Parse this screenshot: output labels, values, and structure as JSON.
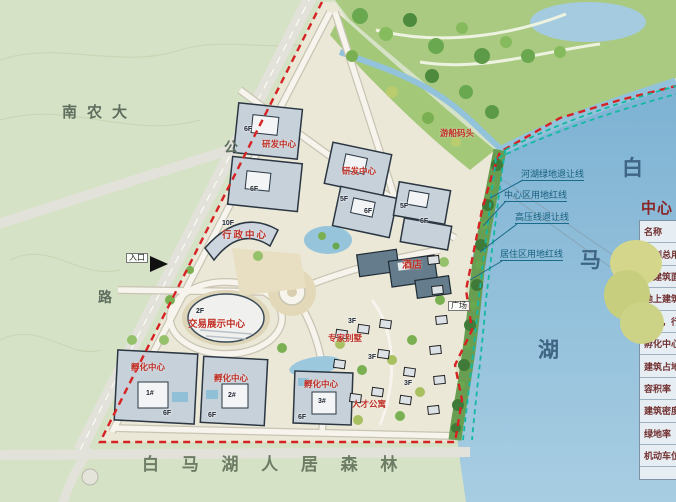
{
  "colors": {
    "boundary_red": "#d62222",
    "setback_teal": "#14b8a3",
    "lake_blue": "#8fbfdc",
    "label_red": "#c03026"
  },
  "map": {
    "campus_label": "南农大",
    "road_char_top": "公",
    "road_char_left": "路",
    "forest_label": "白 马 湖 人 居 森 林",
    "lake_chars": [
      "白",
      "马",
      "湖"
    ],
    "entrance_label": "入口",
    "plaza_label": "广场",
    "hotel_label": "酒店",
    "admin_floor": "10F",
    "admin_label": "行政中心",
    "exhibition_floor": "2F",
    "exhibition_label": "交易展示中心",
    "rnd_label": "研发中心",
    "dock_label": "游船码头",
    "villa_label": "专家别墅",
    "apartment_label": "人才公寓",
    "incubator_label": "孵化中心",
    "incubator_units": [
      "1#",
      "2#",
      "3#"
    ],
    "floors": {
      "f3": "3F",
      "f5": "5F",
      "f6": "6F"
    },
    "setback_lines": [
      {
        "label": "河湖绿地退让线"
      },
      {
        "label": "中心区用地红线"
      },
      {
        "label": "高压线退让线"
      },
      {
        "label": "居住区用地红线"
      }
    ]
  },
  "legend": {
    "title": "中心区",
    "rows": [
      "名称",
      "规划总用地",
      "总建筑面积",
      "地上建筑面积",
      "其他，行政中心",
      "孵化中心",
      "建筑占地面积",
      "容积率",
      "建筑密度",
      "绿地率",
      "机动车位"
    ]
  }
}
